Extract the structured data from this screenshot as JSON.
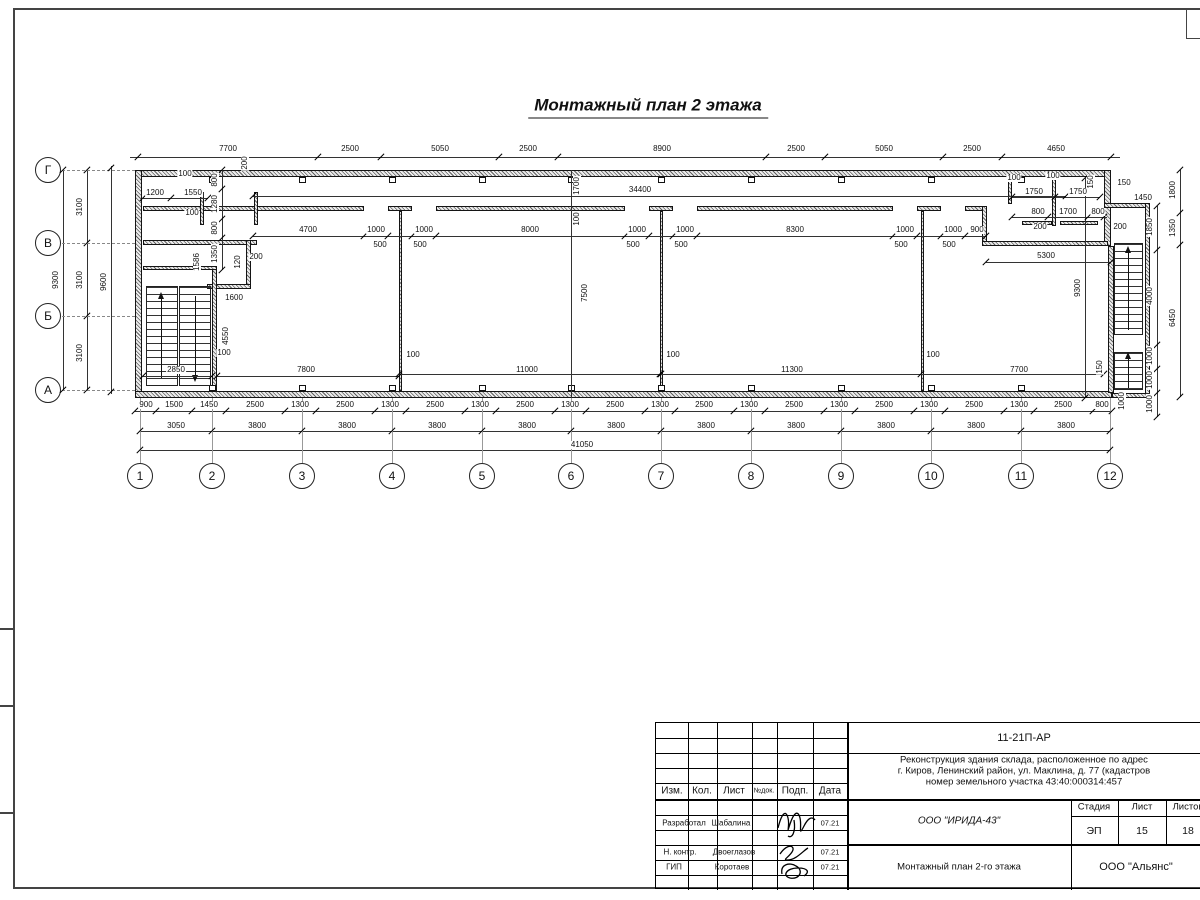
{
  "drawing_title": "Монтажный план 2 этажа",
  "plan": {
    "axes_bottom": [
      {
        "label": "1",
        "x": 140
      },
      {
        "label": "2",
        "x": 212
      },
      {
        "label": "3",
        "x": 302
      },
      {
        "label": "4",
        "x": 392
      },
      {
        "label": "5",
        "x": 482
      },
      {
        "label": "6",
        "x": 571
      },
      {
        "label": "7",
        "x": 661
      },
      {
        "label": "8",
        "x": 751
      },
      {
        "label": "9",
        "x": 841
      },
      {
        "label": "10",
        "x": 931
      },
      {
        "label": "11",
        "x": 1021
      },
      {
        "label": "12",
        "x": 1110
      }
    ],
    "axes_left": [
      {
        "label": "Г",
        "y": 170
      },
      {
        "label": "В",
        "y": 243
      },
      {
        "label": "Б",
        "y": 316
      },
      {
        "label": "А",
        "y": 390
      }
    ],
    "walls": [
      [
        135,
        170,
        976,
        7
      ],
      [
        135,
        170,
        7,
        228
      ],
      [
        135,
        391,
        977,
        7
      ],
      [
        1104,
        170,
        7,
        76
      ],
      [
        1108,
        246,
        6,
        147
      ],
      [
        1104,
        203,
        46,
        5
      ],
      [
        1145,
        203,
        5,
        195
      ],
      [
        1112,
        393,
        38,
        5
      ],
      [
        253,
        206,
        111,
        5
      ],
      [
        388,
        206,
        24,
        5
      ],
      [
        436,
        206,
        189,
        5
      ],
      [
        649,
        206,
        24,
        5
      ],
      [
        697,
        206,
        196,
        5
      ],
      [
        917,
        206,
        24,
        5
      ],
      [
        965,
        206,
        21,
        5
      ],
      [
        982,
        206,
        5,
        36
      ],
      [
        982,
        241,
        126,
        5
      ],
      [
        399,
        211,
        3,
        180
      ],
      [
        660,
        211,
        3,
        180
      ],
      [
        921,
        211,
        3,
        180
      ],
      [
        143,
        206,
        115,
        5
      ],
      [
        200,
        192,
        4,
        33
      ],
      [
        254,
        192,
        4,
        33
      ],
      [
        143,
        240,
        114,
        5
      ],
      [
        246,
        240,
        5,
        48
      ],
      [
        207,
        284,
        44,
        5
      ],
      [
        212,
        266,
        5,
        125
      ],
      [
        143,
        266,
        74,
        4
      ],
      [
        1008,
        178,
        4,
        26
      ],
      [
        1052,
        178,
        4,
        48
      ],
      [
        1022,
        221,
        30,
        4
      ],
      [
        1060,
        221,
        38,
        4
      ]
    ],
    "squares_top_y": 177,
    "squares_bottom_y": 385,
    "squares_x": [
      209,
      299,
      389,
      479,
      568,
      658,
      748,
      838,
      928,
      1018
    ],
    "stairs": [
      [
        146,
        286,
        32,
        100
      ],
      [
        179,
        286,
        32,
        100
      ],
      [
        1114,
        243,
        29,
        92
      ],
      [
        1114,
        352,
        29,
        38
      ]
    ],
    "stair_arrows": [
      [
        161,
        296,
        378,
        "up"
      ],
      [
        195,
        296,
        378,
        "down"
      ],
      [
        1128,
        250,
        330,
        "up"
      ],
      [
        1128,
        356,
        388,
        "up"
      ]
    ],
    "hlines": [
      [
        130,
        157,
        990
      ],
      [
        135,
        411,
        977
      ],
      [
        140,
        431,
        970
      ],
      [
        140,
        450,
        970
      ],
      [
        253,
        196,
        813
      ],
      [
        253,
        236,
        733
      ],
      [
        986,
        262,
        125
      ],
      [
        1012,
        197,
        88
      ],
      [
        1012,
        217,
        95
      ],
      [
        143,
        198,
        65
      ],
      [
        143,
        376,
        69
      ],
      [
        217,
        376,
        182
      ],
      [
        399,
        374,
        261
      ],
      [
        661,
        374,
        260
      ],
      [
        921,
        374,
        183
      ]
    ],
    "vlines": [
      [
        63,
        170,
        220
      ],
      [
        87,
        170,
        220
      ],
      [
        111,
        166,
        228
      ],
      [
        222,
        170,
        100
      ],
      [
        1085,
        178,
        220
      ],
      [
        1157,
        206,
        211
      ],
      [
        1180,
        170,
        227
      ],
      [
        571,
        170,
        293
      ]
    ],
    "axis_vline_y": [
      398,
      463
    ],
    "leaders_left_y": [
      170,
      243,
      316,
      390
    ],
    "ticks_h": [
      {
        "y": 157,
        "x": [
          138,
          318,
          381,
          499,
          558,
          766,
          825,
          943,
          1002,
          1111
        ]
      },
      {
        "y": 411,
        "x": [
          135,
          156,
          192,
          226,
          285,
          316,
          375,
          406,
          465,
          496,
          555,
          586,
          645,
          675,
          734,
          765,
          824,
          855,
          914,
          945,
          1004,
          1034,
          1093,
          1112
        ]
      },
      {
        "y": 431,
        "x": [
          140,
          212,
          302,
          392,
          482,
          571,
          661,
          751,
          841,
          931,
          1021,
          1110
        ]
      },
      {
        "y": 450,
        "x": [
          140,
          1110
        ]
      },
      {
        "y": 236,
        "x": [
          253,
          364,
          388,
          412,
          436,
          625,
          649,
          673,
          697,
          893,
          917,
          941,
          965,
          986
        ]
      },
      {
        "y": 196,
        "x": [
          253,
          1066
        ]
      },
      {
        "y": 262,
        "x": [
          986,
          1111
        ]
      },
      {
        "y": 197,
        "x": [
          1012,
          1055,
          1100
        ]
      },
      {
        "y": 217,
        "x": [
          1012,
          1048,
          1088,
          1104
        ]
      },
      {
        "y": 198,
        "x": [
          143,
          171,
          208
        ]
      },
      {
        "y": 376,
        "x": [
          143,
          212,
          217,
          399
        ]
      },
      {
        "y": 374,
        "x": [
          399,
          660,
          661,
          921,
          1104
        ]
      }
    ],
    "ticks_v": [
      {
        "x": 63,
        "y": [
          170,
          390
        ]
      },
      {
        "x": 87,
        "y": [
          170,
          243,
          316,
          390
        ]
      },
      {
        "x": 111,
        "y": [
          168,
          392
        ]
      },
      {
        "x": 222,
        "y": [
          170,
          189,
          219,
          238,
          270
        ]
      },
      {
        "x": 1085,
        "y": [
          178,
          398
        ]
      },
      {
        "x": 1157,
        "y": [
          206,
          250,
          345,
          369,
          393,
          417
        ]
      },
      {
        "x": 1180,
        "y": [
          170,
          213,
          245,
          397
        ]
      }
    ],
    "labels": [
      [
        "7700",
        228,
        149,
        0
      ],
      [
        "2500",
        350,
        149,
        0
      ],
      [
        "5050",
        440,
        149,
        0
      ],
      [
        "2500",
        528,
        149,
        0
      ],
      [
        "8900",
        662,
        149,
        0
      ],
      [
        "2500",
        796,
        149,
        0
      ],
      [
        "5050",
        884,
        149,
        0
      ],
      [
        "2500",
        972,
        149,
        0
      ],
      [
        "4650",
        1056,
        149,
        0
      ],
      [
        "200",
        245,
        163,
        1
      ],
      [
        "900",
        146,
        405,
        0
      ],
      [
        "1500",
        174,
        405,
        0
      ],
      [
        "1450",
        209,
        405,
        0
      ],
      [
        "2500",
        255,
        405,
        0
      ],
      [
        "1300",
        300,
        405,
        0
      ],
      [
        "2500",
        345,
        405,
        0
      ],
      [
        "1300",
        390,
        405,
        0
      ],
      [
        "2500",
        435,
        405,
        0
      ],
      [
        "1300",
        480,
        405,
        0
      ],
      [
        "2500",
        525,
        405,
        0
      ],
      [
        "1300",
        570,
        405,
        0
      ],
      [
        "2500",
        615,
        405,
        0
      ],
      [
        "1300",
        660,
        405,
        0
      ],
      [
        "2500",
        704,
        405,
        0
      ],
      [
        "1300",
        749,
        405,
        0
      ],
      [
        "2500",
        794,
        405,
        0
      ],
      [
        "1300",
        839,
        405,
        0
      ],
      [
        "2500",
        884,
        405,
        0
      ],
      [
        "1300",
        929,
        405,
        0
      ],
      [
        "2500",
        974,
        405,
        0
      ],
      [
        "1300",
        1019,
        405,
        0
      ],
      [
        "2500",
        1063,
        405,
        0
      ],
      [
        "800",
        1102,
        405,
        0
      ],
      [
        "3050",
        176,
        426,
        0
      ],
      [
        "3800",
        257,
        426,
        0
      ],
      [
        "3800",
        347,
        426,
        0
      ],
      [
        "3800",
        437,
        426,
        0
      ],
      [
        "3800",
        527,
        426,
        0
      ],
      [
        "3800",
        616,
        426,
        0
      ],
      [
        "3800",
        706,
        426,
        0
      ],
      [
        "3800",
        796,
        426,
        0
      ],
      [
        "3800",
        886,
        426,
        0
      ],
      [
        "3800",
        976,
        426,
        0
      ],
      [
        "3800",
        1066,
        426,
        0
      ],
      [
        "41050",
        582,
        445,
        0
      ],
      [
        "9300",
        56,
        280,
        1
      ],
      [
        "3100",
        80,
        207,
        1
      ],
      [
        "3100",
        80,
        280,
        1
      ],
      [
        "3100",
        80,
        353,
        1
      ],
      [
        "9600",
        104,
        282,
        1
      ],
      [
        "4700",
        308,
        230,
        0
      ],
      [
        "1000",
        376,
        230,
        0
      ],
      [
        "1000",
        424,
        230,
        0
      ],
      [
        "8000",
        530,
        230,
        0
      ],
      [
        "1000",
        637,
        230,
        0
      ],
      [
        "1000",
        685,
        230,
        0
      ],
      [
        "8300",
        795,
        230,
        0
      ],
      [
        "1000",
        905,
        230,
        0
      ],
      [
        "1000",
        953,
        230,
        0
      ],
      [
        "900",
        977,
        230,
        0
      ],
      [
        "500",
        380,
        245,
        0
      ],
      [
        "500",
        420,
        245,
        0
      ],
      [
        "500",
        633,
        245,
        0
      ],
      [
        "500",
        681,
        245,
        0
      ],
      [
        "500",
        901,
        245,
        0
      ],
      [
        "500",
        949,
        245,
        0
      ],
      [
        "34400",
        640,
        190,
        0
      ],
      [
        "1700",
        577,
        186,
        1
      ],
      [
        "100",
        577,
        219,
        1
      ],
      [
        "5300",
        1046,
        256,
        0
      ],
      [
        "9300",
        1078,
        288,
        1
      ],
      [
        "7500",
        585,
        293,
        1
      ],
      [
        "7800",
        306,
        370,
        0
      ],
      [
        "11000",
        527,
        370,
        0
      ],
      [
        "11300",
        792,
        370,
        0
      ],
      [
        "7700",
        1019,
        370,
        0
      ],
      [
        "2850",
        176,
        370,
        0
      ],
      [
        "100",
        413,
        355,
        0
      ],
      [
        "100",
        673,
        355,
        0
      ],
      [
        "100",
        933,
        355,
        0
      ],
      [
        "100",
        224,
        353,
        0
      ],
      [
        "100",
        185,
        174,
        0
      ],
      [
        "1200",
        155,
        193,
        0
      ],
      [
        "1550",
        193,
        193,
        0
      ],
      [
        "100",
        192,
        213,
        0
      ],
      [
        "800",
        215,
        180,
        1
      ],
      [
        "1280",
        215,
        204,
        1
      ],
      [
        "800",
        215,
        228,
        1
      ],
      [
        "1350",
        215,
        254,
        1
      ],
      [
        "120",
        238,
        262,
        1
      ],
      [
        "200",
        256,
        257,
        0
      ],
      [
        "1586",
        197,
        262,
        1
      ],
      [
        "1600",
        234,
        298,
        0
      ],
      [
        "4550",
        226,
        336,
        1
      ],
      [
        "100",
        1014,
        178,
        0
      ],
      [
        "100",
        1053,
        176,
        0
      ],
      [
        "150",
        1091,
        182,
        1
      ],
      [
        "150",
        1124,
        183,
        0
      ],
      [
        "1450",
        1143,
        198,
        0
      ],
      [
        "1750",
        1034,
        192,
        0
      ],
      [
        "1750",
        1078,
        192,
        0
      ],
      [
        "800",
        1038,
        212,
        0
      ],
      [
        "1700",
        1068,
        212,
        0
      ],
      [
        "800",
        1098,
        212,
        0
      ],
      [
        "200",
        1040,
        227,
        0
      ],
      [
        "200",
        1120,
        227,
        0
      ],
      [
        "1800",
        1173,
        190,
        1
      ],
      [
        "1350",
        1173,
        228,
        1
      ],
      [
        "6450",
        1173,
        318,
        1
      ],
      [
        "1850",
        1150,
        227,
        1
      ],
      [
        "4000",
        1150,
        296,
        1
      ],
      [
        "1000",
        1150,
        356,
        1
      ],
      [
        "1000",
        1150,
        380,
        1
      ],
      [
        "1000",
        1150,
        404,
        1
      ],
      [
        "150",
        1100,
        367,
        1
      ],
      [
        "1000",
        1122,
        401,
        1
      ]
    ]
  },
  "frame": {
    "binding_ticks_y": [
      628,
      705,
      812
    ]
  },
  "title_block": {
    "doc_code": "11-21П-АР",
    "project_line1": "Реконструкция здания склада, расположенное по адрес",
    "project_line2": "г. Киров, Ленинский район, ул. Маклина, д. 77 (кадастров",
    "project_line3": "номер земельного участка 43:40:000314:457",
    "columns": {
      "c1": "Изм.",
      "c2": "Кол.",
      "c3": "Лист",
      "c4": "№док.",
      "c5": "Подп.",
      "c6": "Дата"
    },
    "row_dev": {
      "role": "Разработал",
      "name": "Шабалина",
      "date": "07.21"
    },
    "row_ncontr": {
      "role": "Н. контр.",
      "name": "Двоеглазов",
      "date": "07.21"
    },
    "row_gip": {
      "role": "ГИП",
      "name": "Коротаев",
      "date": "07.21"
    },
    "org": "ООО \"ИРИДА-43\"",
    "stage_label": "Стадия",
    "sheet_label": "Лист",
    "sheets_label": "Листов",
    "stage": "ЭП",
    "sheet": "15",
    "sheets": "18",
    "sheet_title": "Монтажный план 2-го этажа",
    "company": "ООО \"Альянс\""
  }
}
